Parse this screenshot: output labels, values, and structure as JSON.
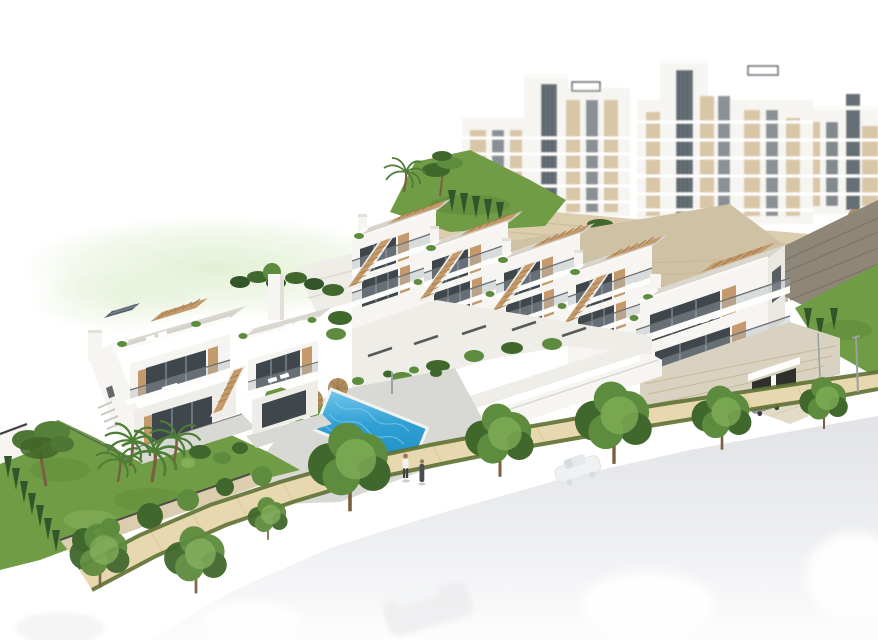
{
  "alt_text": "Aerial 3D architectural rendering of a hillside residential development: a row of white townhouses with tan wooden stairs and roof terraces, a two-unit villa on the left, a blue communal swimming pool with sun loungers and two parasols, landscaped gardens with palms and pines, large white apartment blocks behind on the upper terrace, a sandy pedestrian path, and a pale fading road with cars in the foreground.",
  "palette": {
    "bg": "#ffffff",
    "halo": "#dcecc9",
    "bld_white": "#f6f5f1",
    "bld_white2": "#efede7",
    "bld_side": "#eae8e1",
    "bld_shade": "#e2e0d9",
    "roof_deck": "#d9d7cf",
    "roof_deck2": "#cfcdc4",
    "glass_dark": "#3f464c",
    "glass_mid": "#626a72",
    "glass_light": "#a9b4ba",
    "wood": "#c49a6c",
    "wood_dark": "#a07748",
    "stone_sand": "#dbcdad",
    "stone_sand_line": "#c2b28d",
    "stone_beige": "#cfc1a3",
    "stone_dark": "#8e8778",
    "stone_dark_line": "#766f60",
    "base_stone": "#d9d2c0",
    "lawn": "#6f9c45",
    "lawn_dark": "#527c31",
    "hedge": "#32562a",
    "tree": "#5d8c3e",
    "tree_dark": "#41682c",
    "tree_light": "#82af58",
    "palm": "#4e7d37",
    "pool": "#2f9fd4",
    "pool_light": "#74c8ea",
    "deck": "#d8d9d5",
    "deck_wall": "#4c4c46",
    "path": "#e7d8b0",
    "path_edge": "#5e7133",
    "drive": "#e2dbc6",
    "road": "#e2e3e6",
    "road_fade": "#fdfdfe",
    "car_gray": "#8e9296",
    "car_gray_dark": "#6e7276",
    "umbrella": "#b18c5c",
    "rail": "#6a6f73",
    "skin": "#9a7a5f",
    "person_dark": "#4a4f55",
    "trunk": "#7c5f41"
  },
  "scene": {
    "townhouse_row_units": 5,
    "villa_units": 2,
    "background_apartment_blocks": 3,
    "pools": 2,
    "parasols": 3,
    "people_on_path": 2,
    "parked_gray_cars": 1,
    "faded_foreground_cars": 4
  }
}
